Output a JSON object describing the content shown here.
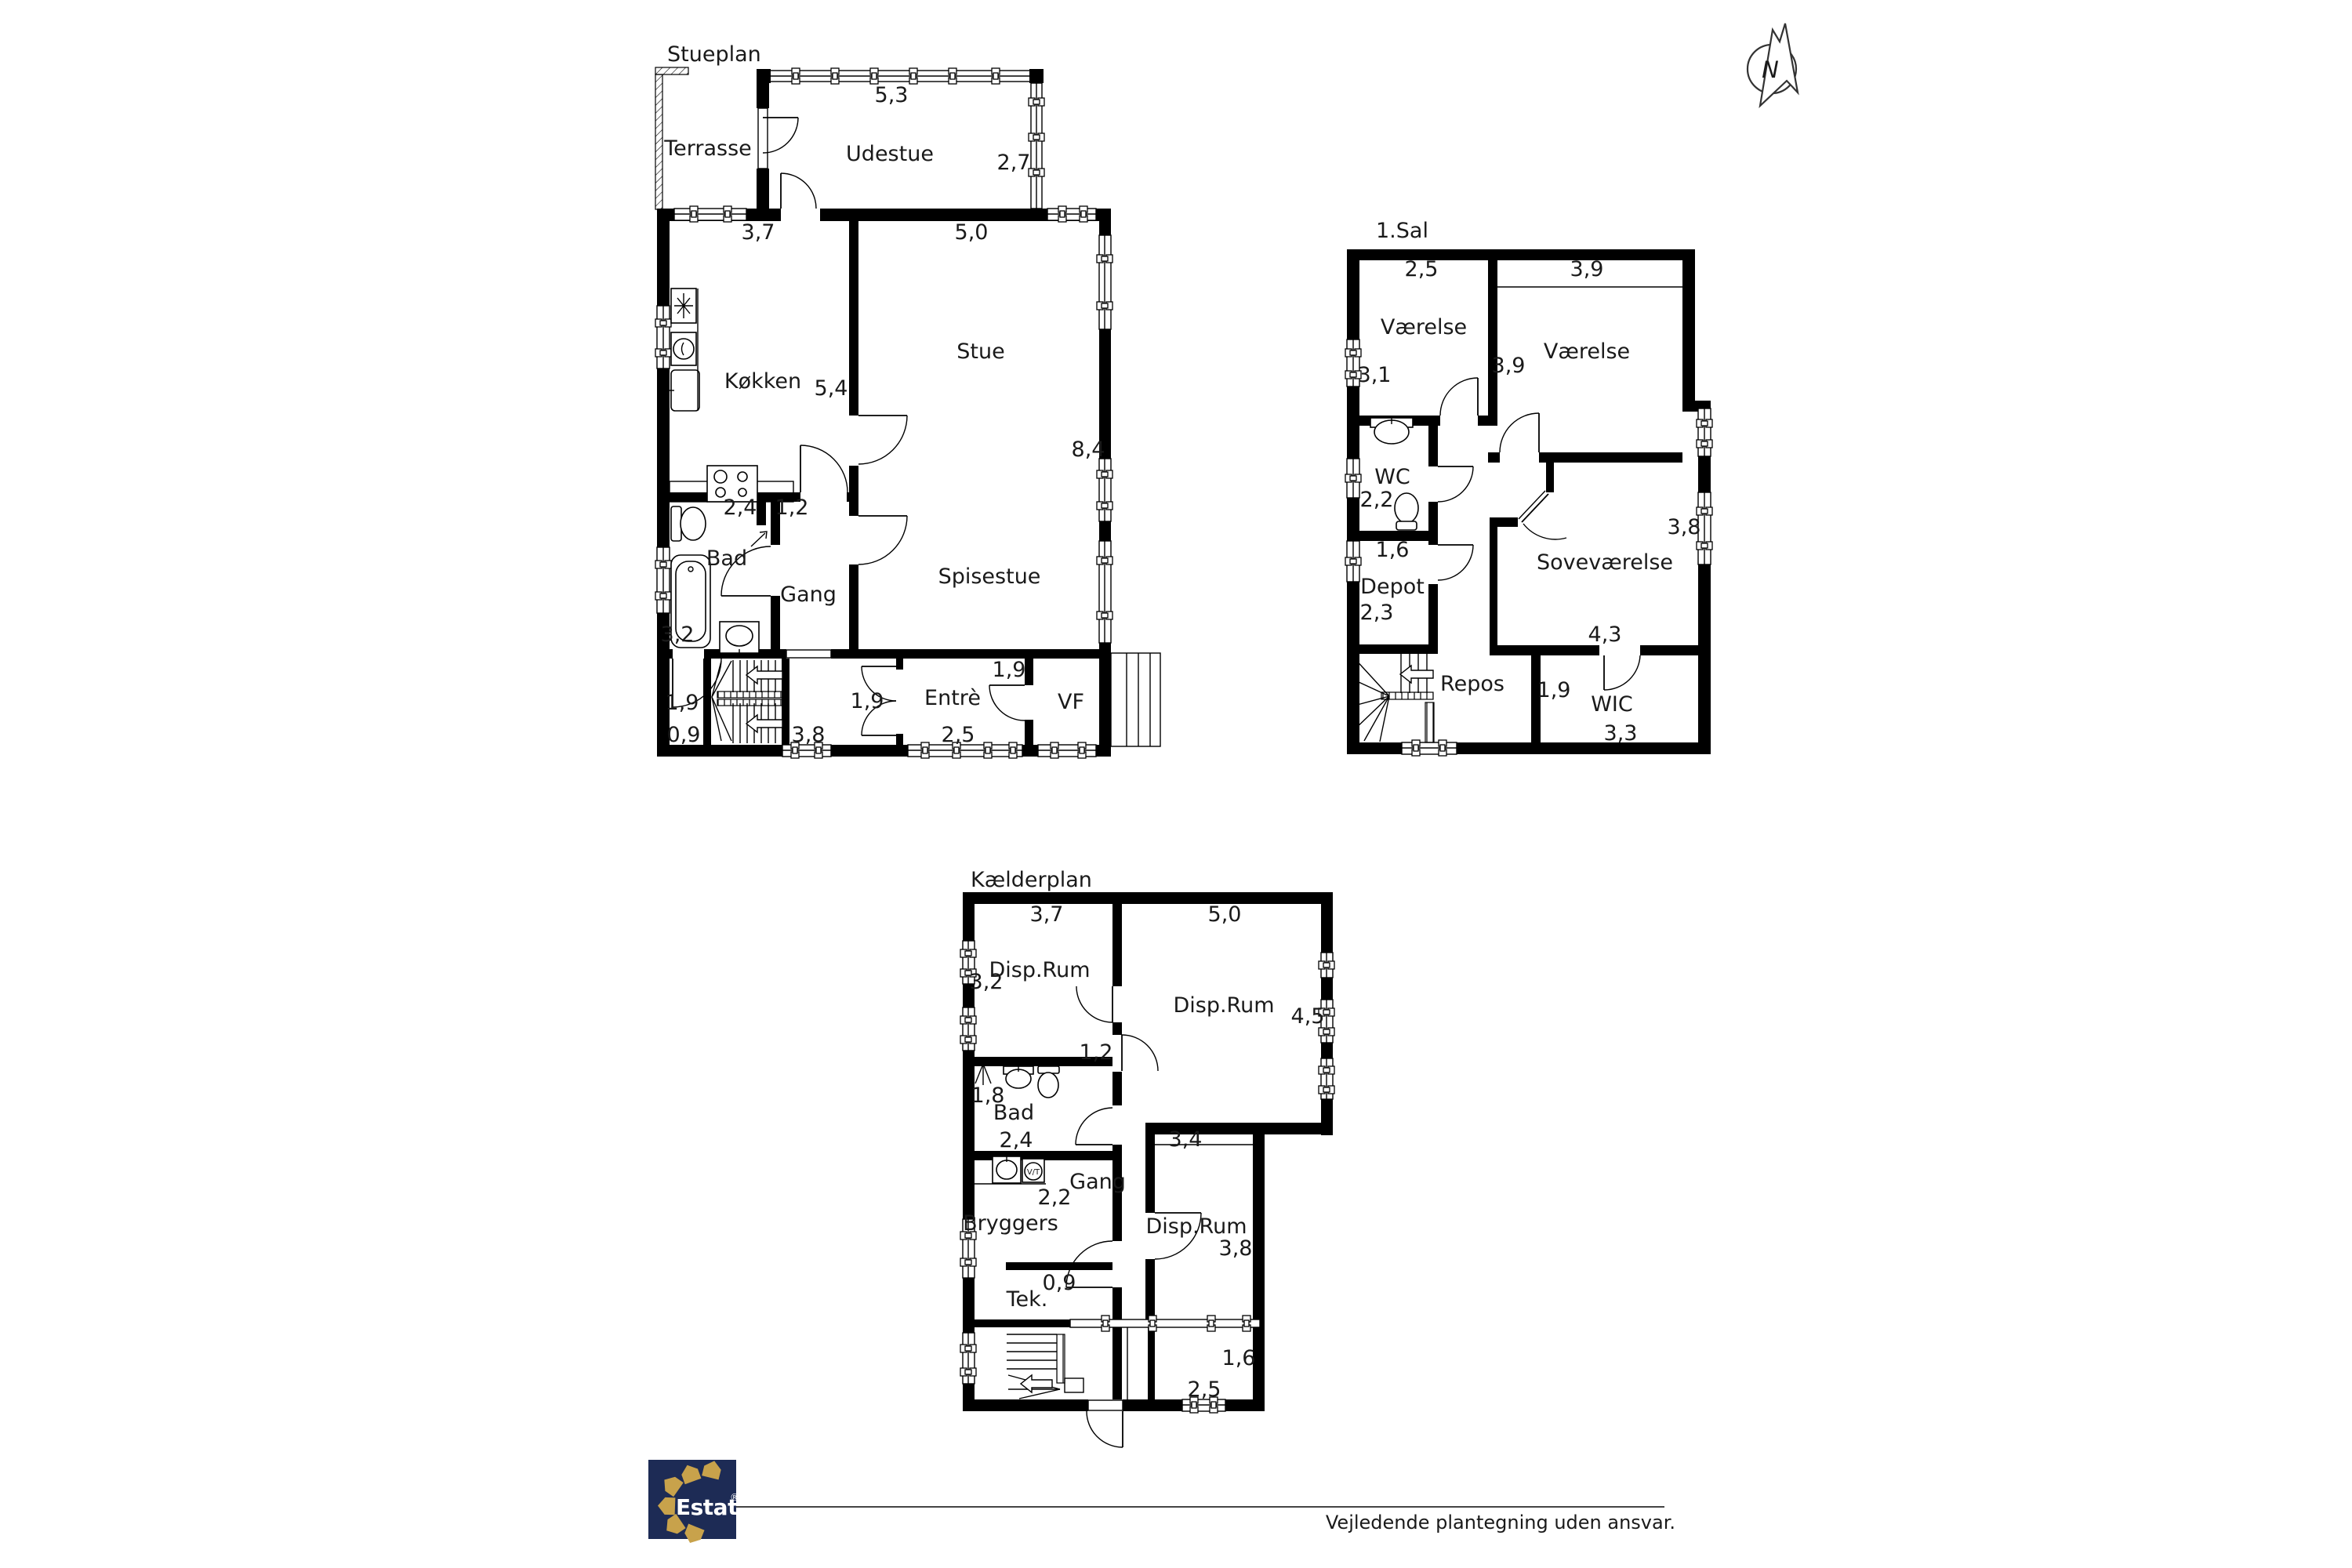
{
  "stueplan": {
    "title": "Stueplan",
    "rooms": {
      "terrasse": "Terrasse",
      "udestue": "Udestue",
      "kokken": "Køkken",
      "stue": "Stue",
      "bad": "Bad",
      "gang": "Gang",
      "spisestue": "Spisestue",
      "entre": "Entrè",
      "vf": "VF"
    },
    "dims": {
      "udestue_width": "5,3",
      "udestue_depth": "2,7",
      "kokken_width": "3,7",
      "stue_width": "5,0",
      "kokken_depth": "5,4",
      "stue_depth": "8,4",
      "bad_width": "2,4",
      "gang_width": "1,2",
      "bad_depth": "3,2",
      "rum_depth": "1,9",
      "rum_width": "0,9",
      "trappe_width": "3,8",
      "hall_door": "1,9",
      "vf_door": "1,9",
      "entre_width": "2,5"
    }
  },
  "sal1": {
    "title": "1.Sal",
    "rooms": {
      "vaerelse1": "Værelse",
      "vaerelse2": "Værelse",
      "wc": "WC",
      "depot": "Depot",
      "sovevaerelse": "Soveværelse",
      "repos": "Repos",
      "wic": "WIC"
    },
    "dims": {
      "vaerelse1_width": "2,5",
      "vaerelse2_width": "3,9",
      "vaerelse1_depth": "3,1",
      "vaerelse2_depth": "3,9",
      "wc_depth": "2,2",
      "depot_width": "1,6",
      "depot_depth": "2,3",
      "sovevaerelse_depth": "3,8",
      "sovevaerelse_width": "4,3",
      "wic_door": "1,9",
      "wic_width": "3,3"
    }
  },
  "kaelder": {
    "title": "Kælderplan",
    "rooms": {
      "disp1": "Disp.Rum",
      "disp2": "Disp.Rum",
      "disp3": "Disp.Rum",
      "bad": "Bad",
      "gang": "Gang",
      "bryggers": "Bryggers",
      "tek": "Tek."
    },
    "dims": {
      "disp1_width": "3,7",
      "disp2_width": "5,0",
      "disp1_depth": "3,2",
      "disp2_depth": "4,5",
      "gang_pass": "1,2",
      "bad_depth": "1,8",
      "bad_width": "2,4",
      "bryggers_pass": "2,2",
      "disp3_width": "3,4",
      "disp3_depth": "3,8",
      "tek_width": "0,9",
      "rum_depth": "1,6",
      "rum_width": "2,5"
    },
    "washer_label": "V/T"
  },
  "footer": {
    "logo_text": "Estate",
    "logo_reg": "®",
    "disclaimer": "Vejledende plantegning uden ansvar."
  },
  "compass": {
    "north": "N"
  },
  "colors": {
    "wall": "#000000",
    "logo_navy": "#1d2b55",
    "logo_gold": "#c8a24b"
  },
  "icons": [
    "north-compass-icon",
    "fridge-icon",
    "oven-icon",
    "kitchen-sink-icon",
    "stove-icon",
    "toilet-icon",
    "bathtub-icon",
    "hand-sink-icon",
    "shower-icon",
    "washing-machine-icon",
    "stairs-icon",
    "estate-logo"
  ]
}
